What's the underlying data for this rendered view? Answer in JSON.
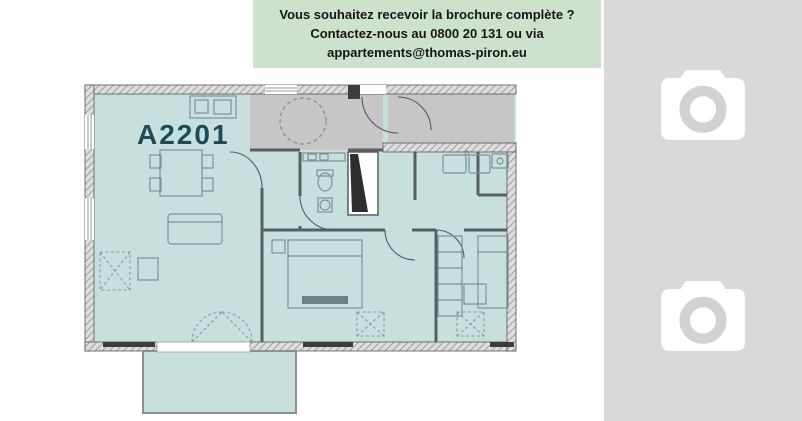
{
  "banner": {
    "lines": [
      "Vous souhaitez recevoir la brochure complète ?",
      "Contactez-nous au 0800 20 131 ou via",
      "appartements@thomas-piron.eu"
    ],
    "bg_color": "#cde2cd",
    "text_color": "#161616"
  },
  "floor_plan": {
    "unit_label": "A2201",
    "label_color": "#1d4b55",
    "room_fill": "#c7e0dd",
    "hall_fill": "#c6c6c6",
    "wall_color": "#8f8f8f"
  },
  "photo_panel": {
    "bg_color": "#d9d9d8",
    "icon_color": "#ffffff",
    "lens_color": "#d2d2d1",
    "placeholders": [
      {
        "icon": "camera-icon"
      },
      {
        "icon": "camera-icon"
      }
    ]
  }
}
